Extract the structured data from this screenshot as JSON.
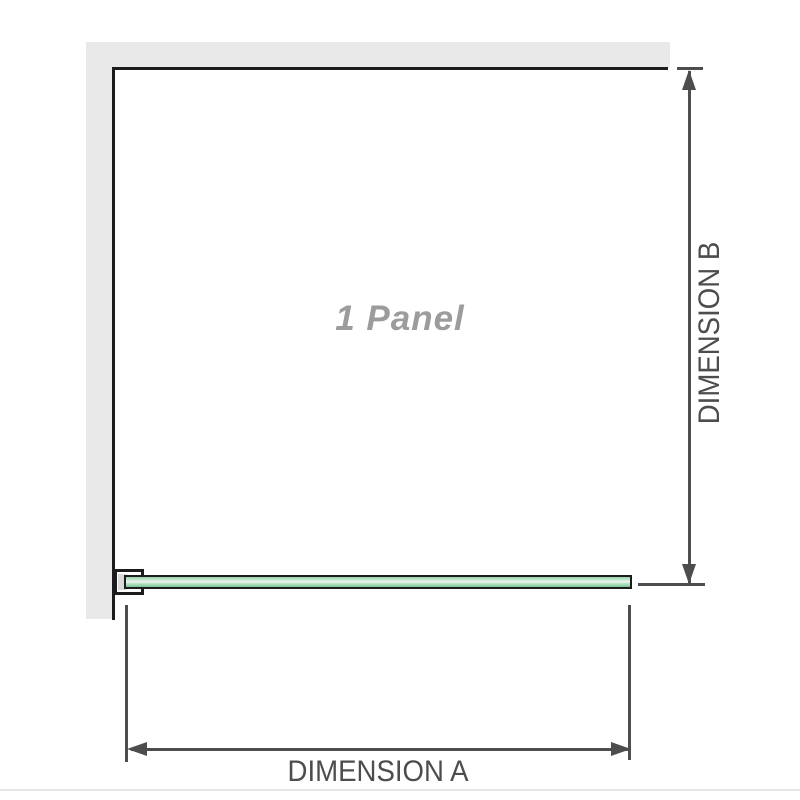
{
  "diagram": {
    "panel_label": "1 Panel",
    "dimension_a_label": "DIMENSION A",
    "dimension_b_label": "DIMENSION B"
  },
  "colors": {
    "wall_fill": "#e9e9e9",
    "wall_edge": "#1c1c1c",
    "dim_color": "#4d4d4d",
    "label_gray": "#9c9c9c",
    "glass_green": "#94d2a8",
    "glass_green_light": "#ecf7f0",
    "glass_green_dark": "#7dc294",
    "bracket_inner": "#d9d9d9"
  }
}
